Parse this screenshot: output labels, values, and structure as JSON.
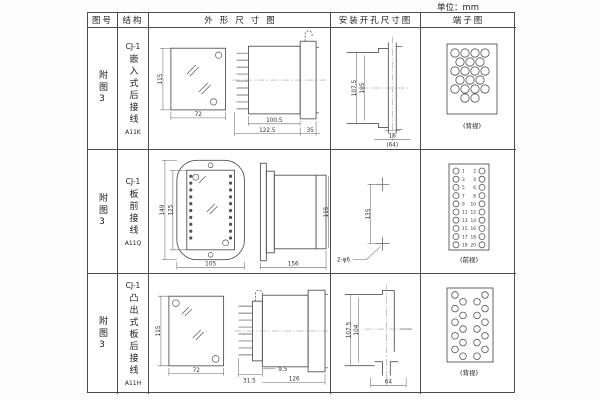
{
  "page": {
    "unit_label": "单位：mm"
  },
  "header": {
    "fig_no": "图号",
    "structure": "结构",
    "outline": "外形尺寸图",
    "mounting": "安装开孔尺寸图",
    "terminal": "端子图"
  },
  "rows": [
    {
      "fig_no": "附图3",
      "series": "CJ-1",
      "structure": "嵌入式后接线",
      "model": "A11K",
      "outline": {
        "front_height": "115",
        "front_width": "72",
        "body_depth": "100.5",
        "total_depth": "122.5",
        "flange_depth": "35"
      },
      "mounting": {
        "outer_height": "107.5",
        "inner_height": "105",
        "slot_width": "16",
        "overall_width": "(64)"
      },
      "terminal": {
        "caption": "(背视)"
      }
    },
    {
      "fig_no": "附图3",
      "series": "CJ-1",
      "structure": "板前接线",
      "model": "A11Q",
      "outline": {
        "plate_height": "149",
        "terminal_height": "125",
        "plate_width": "105",
        "total_depth": "156",
        "body_height": "115"
      },
      "mounting": {
        "hole_spacing": "135",
        "hole_note": "2-φ6"
      },
      "terminal": {
        "caption": "(前视)",
        "left_numbers": [
          1,
          3,
          5,
          7,
          9,
          11,
          13,
          15,
          17,
          19
        ],
        "right_numbers": [
          2,
          4,
          6,
          8,
          10,
          12,
          14,
          16,
          18,
          20
        ]
      }
    },
    {
      "fig_no": "附图3",
      "series": "CJ-1",
      "structure": "凸出式板后接线",
      "model": "A11H",
      "outline": {
        "front_height": "115",
        "front_width": "72",
        "pin_depth": "31.5",
        "gap_depth": "9.5",
        "body_depth": "126"
      },
      "mounting": {
        "outer_height": "107.5",
        "inner_height": "104",
        "slot_width": "64"
      },
      "terminal": {
        "caption": "(背视)"
      }
    }
  ]
}
